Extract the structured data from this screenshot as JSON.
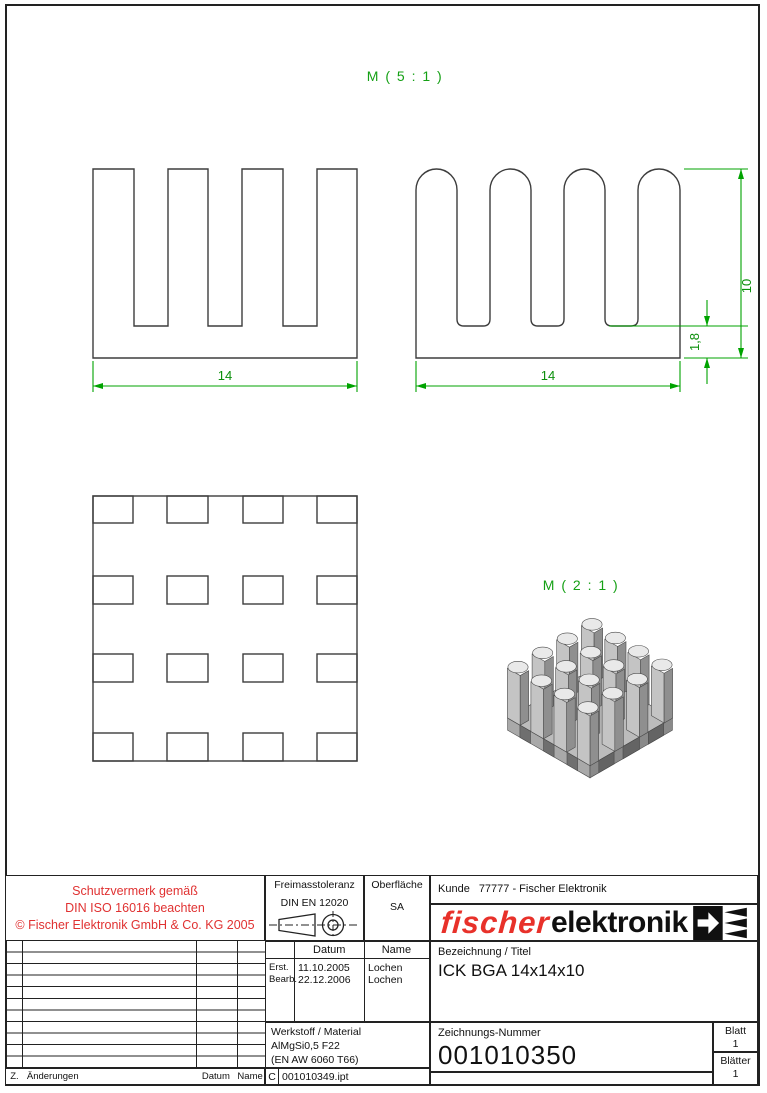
{
  "drawing": {
    "scale_label_main": "M ( 5 : 1 )",
    "scale_label_iso": "M ( 2 : 1 )",
    "dimensions": {
      "front_width": "14",
      "side_width": "14",
      "height": "10",
      "base_thickness": "1,8"
    },
    "colors": {
      "dimension_green": "#00a300",
      "dimension_text_green": "#0b8f0b",
      "outline_dark": "#3d3d3d",
      "note_red": "#e03131",
      "logo_red": "#e8312a"
    }
  },
  "title_block": {
    "protection_note": [
      "Schutzvermerk gemäß",
      "DIN ISO 16016 beachten",
      "© Fischer Elektronik GmbH & Co. KG 2005"
    ],
    "tolerance": {
      "label": "Freimasstoleranz",
      "standard": "DIN EN 12020"
    },
    "surface": {
      "label": "Oberfläche",
      "value": "SA"
    },
    "customer": {
      "label": "Kunde",
      "value": "77777 - Fischer Elektronik"
    },
    "logo": {
      "text_red": "fischer",
      "text_black": "elektronik"
    },
    "dates": {
      "header_date": "Datum",
      "header_name": "Name",
      "rows": [
        {
          "label": "Erst.",
          "date": "11.10.2005",
          "name": "Lochen"
        },
        {
          "label": "Bearb.",
          "date": "22.12.2006",
          "name": "Lochen"
        }
      ]
    },
    "designation": {
      "label": "Bezeichnung / Titel",
      "value": "ICK BGA 14x14x10"
    },
    "material": {
      "label": "Werkstoff / Material",
      "line1": "AlMgSi0,5 F22",
      "line2": "(EN AW 6060 T66)"
    },
    "drawing_number": {
      "label": "Zeichnungs-Nummer",
      "value": "001010350"
    },
    "sheet": {
      "label": "Blatt",
      "value": "1"
    },
    "sheets": {
      "label": "Blätter",
      "value": "1"
    },
    "revision_footer": {
      "z": "Z.",
      "changes": "Änderungen",
      "date": "Datum",
      "name": "Name"
    },
    "file_row": {
      "letter": "C",
      "filename": "001010349.ipt"
    }
  }
}
